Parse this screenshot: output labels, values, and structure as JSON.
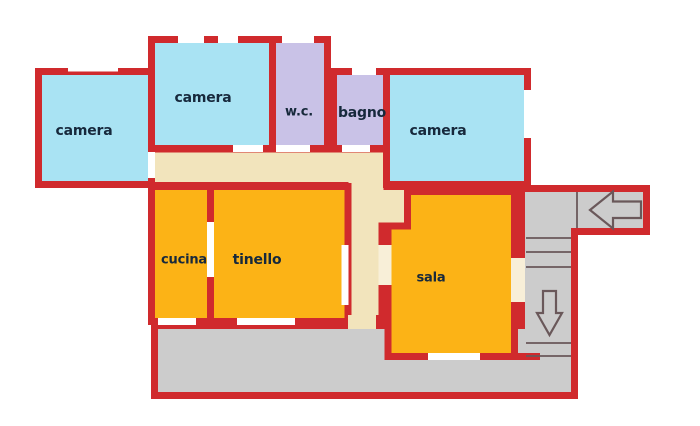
{
  "rooms": {
    "camera_left": "camera",
    "camera_top": "camera",
    "camera_right": "camera",
    "wc": "w.c.",
    "bagno": "bagno",
    "cucina": "cucina",
    "tinello": "tinello",
    "sala": "sala"
  },
  "colors": {
    "wall": "#d02a2d",
    "bedroom": "#a9e3f3",
    "bathroom": "#c9c2e7",
    "living": "#fcb316",
    "corridor": "#f2e4bc",
    "common_area": "#cccccc",
    "opening": "#ffffff",
    "opening_warm": "#f8efd8",
    "stair_line": "#6a585a",
    "label_text": "#17293c",
    "background": "#ffffff"
  },
  "icons": {
    "entrance_arrow": "left-arrow",
    "stairs_arrow": "down-arrow"
  }
}
